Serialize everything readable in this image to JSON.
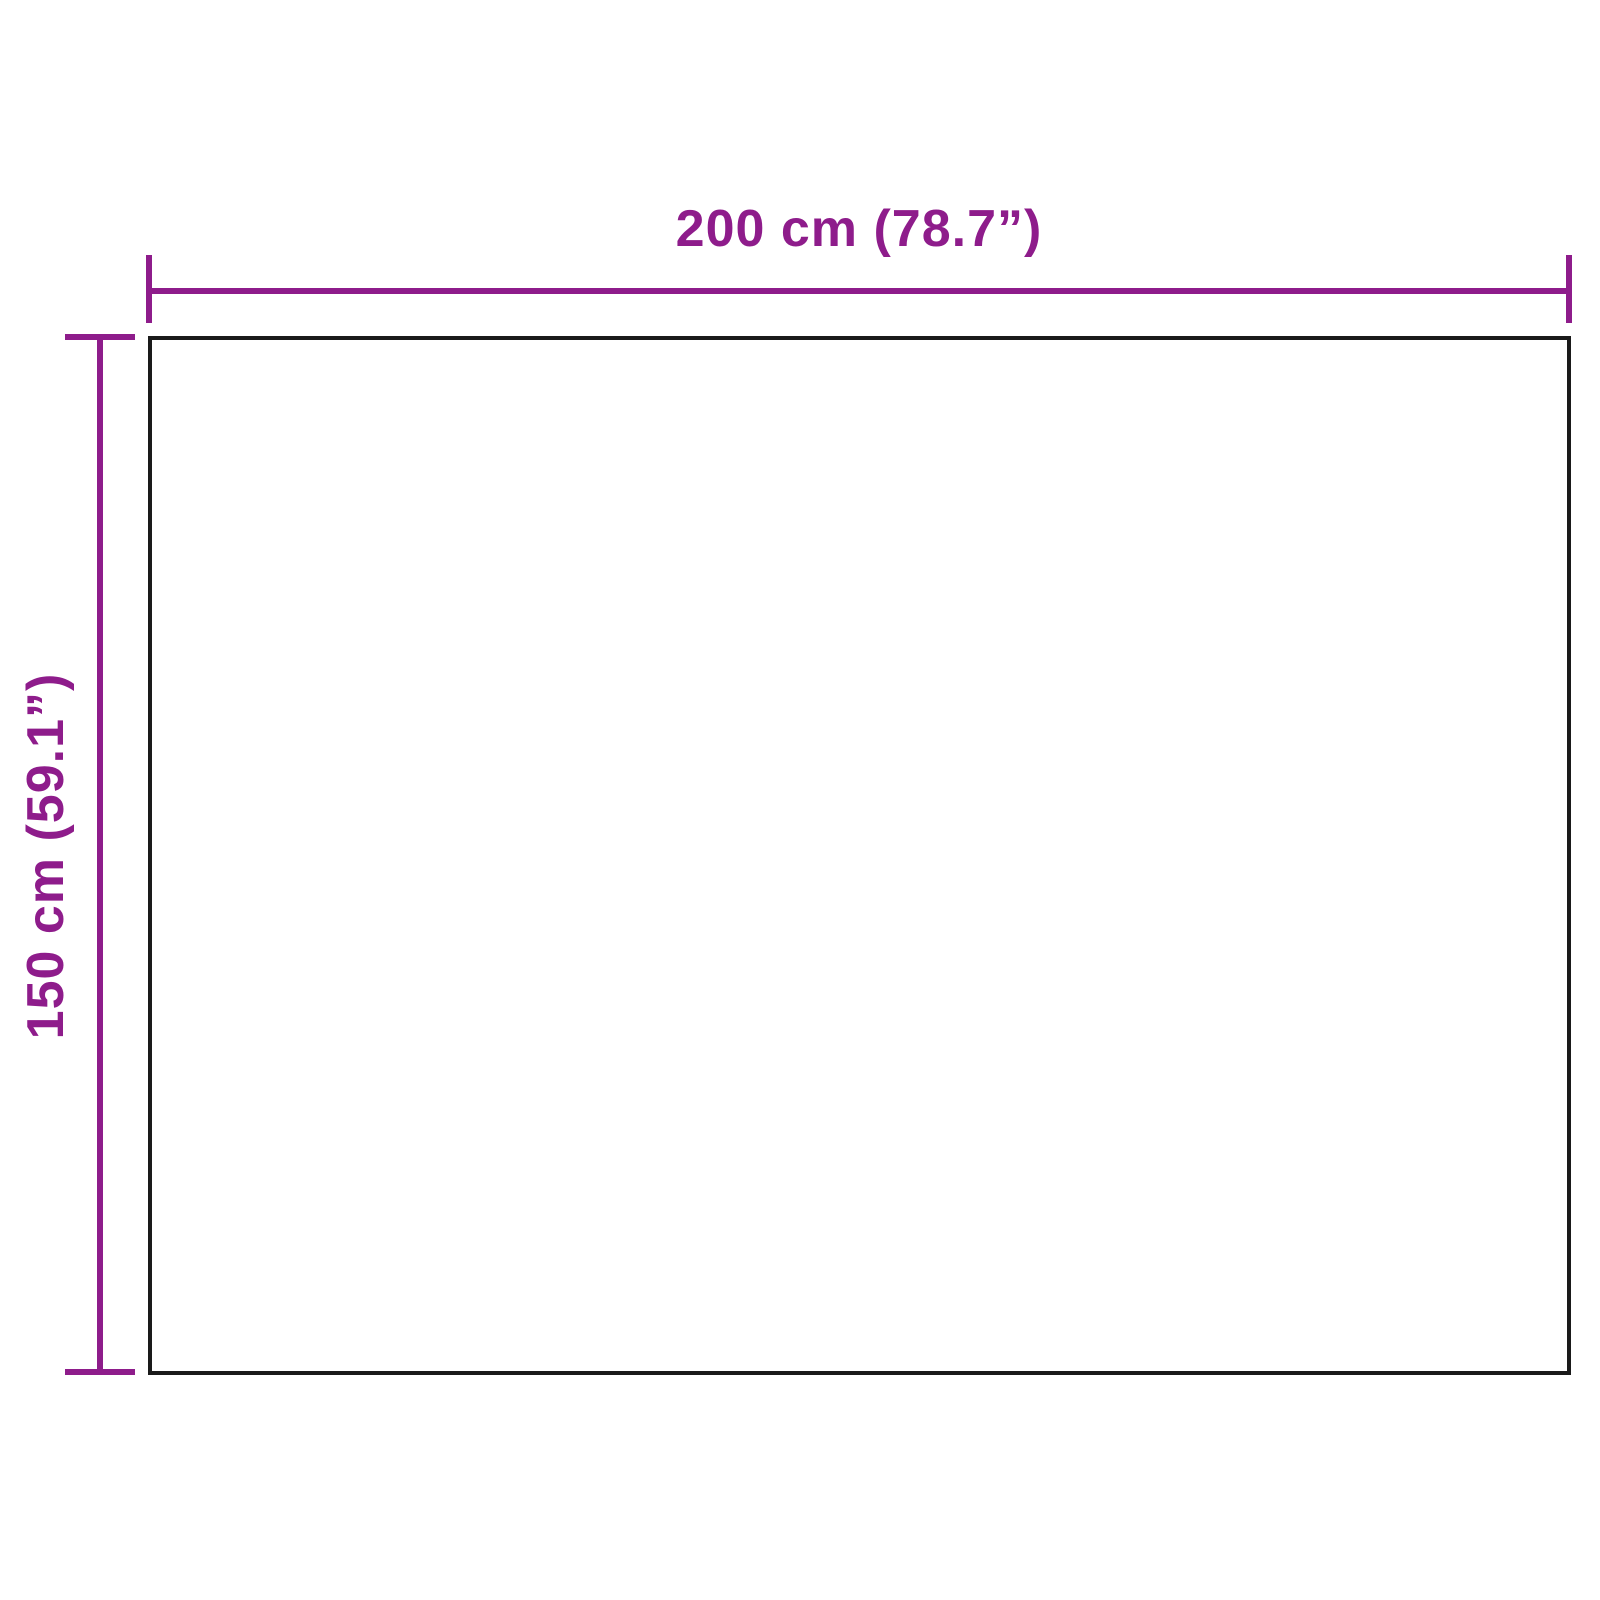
{
  "diagram": {
    "width_dimension": {
      "label": "200 cm (78.7”)"
    },
    "height_dimension": {
      "label": "150 cm (59.1”)"
    },
    "colors": {
      "dimension_accent": "#8E1C8B",
      "outline": "#1A1A1A",
      "background": "#FFFFFF"
    }
  }
}
